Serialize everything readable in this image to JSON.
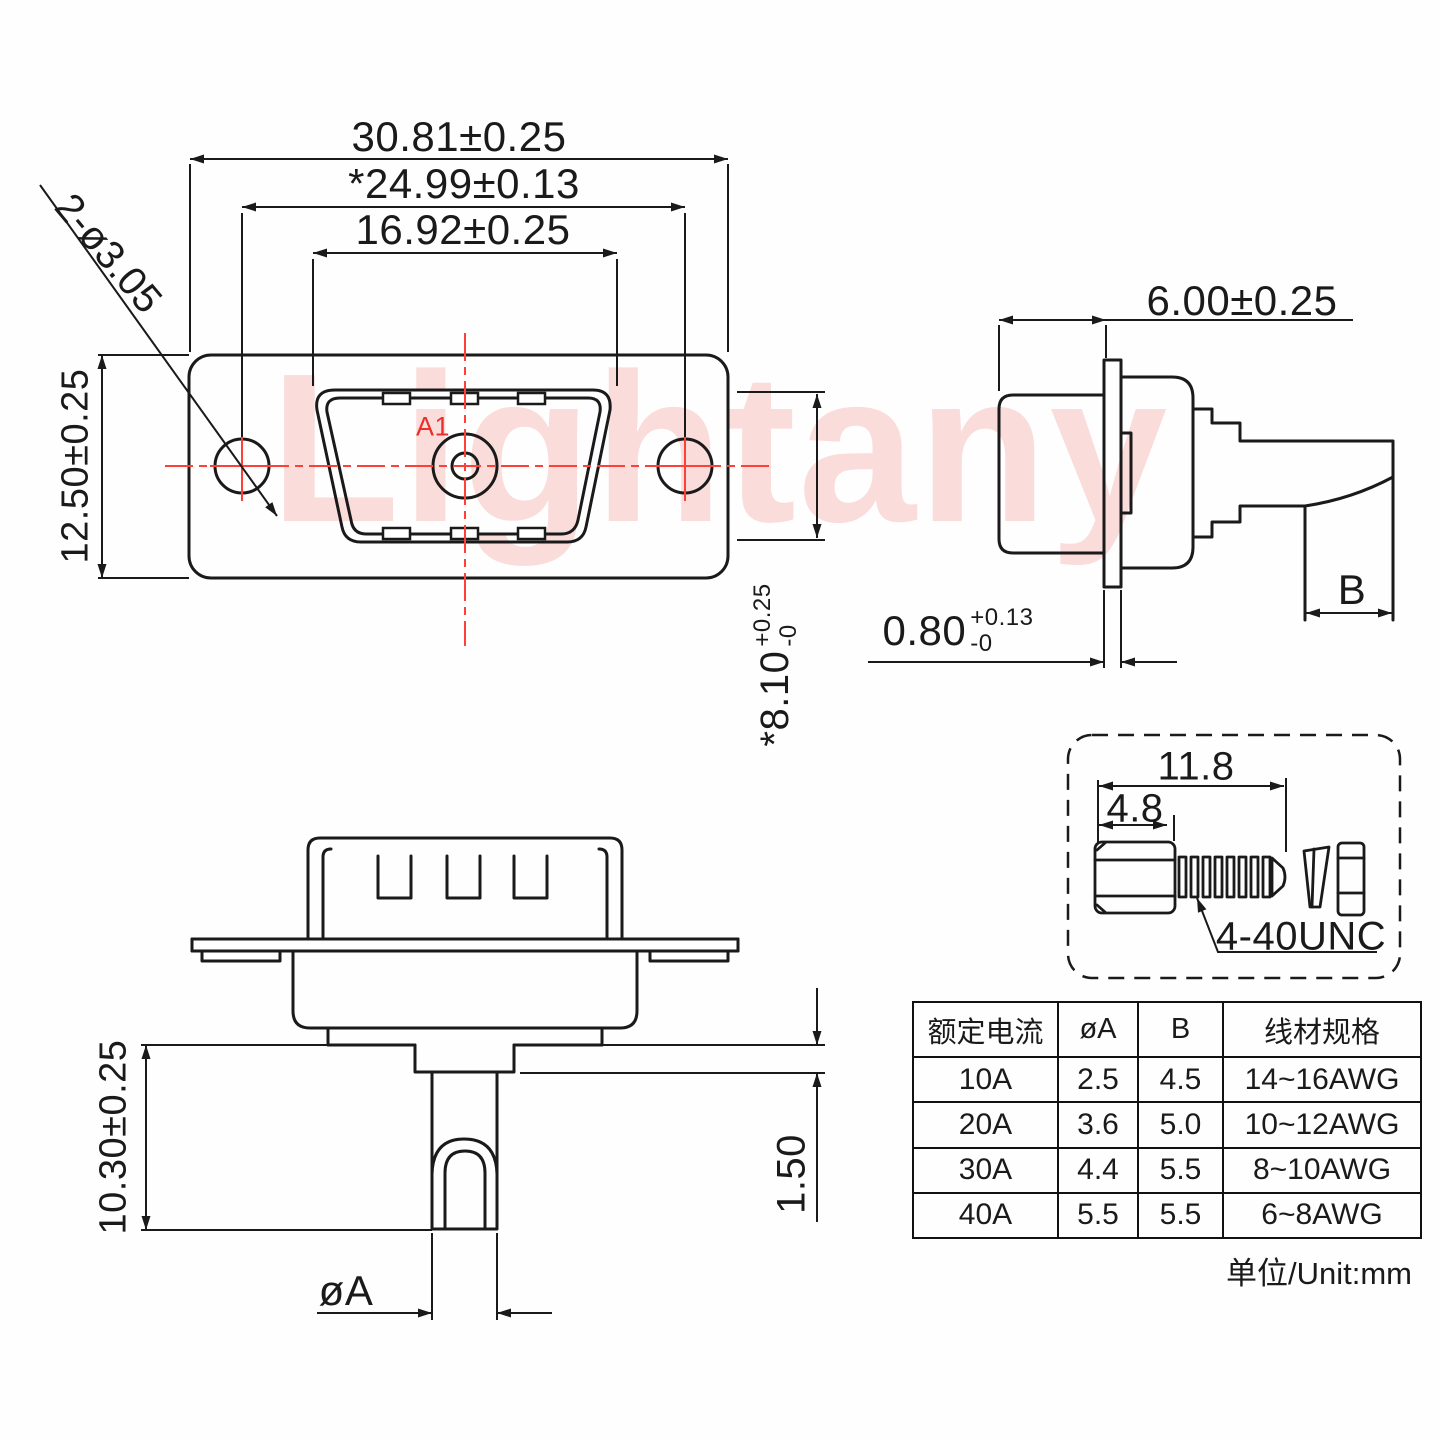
{
  "front_view": {
    "dim_flange_width": "30.81±0.25",
    "dim_hole_span": "*24.99±0.13",
    "dim_shell_width": "16.92±0.25",
    "dim_flange_height": "12.50±0.25",
    "dim_mounting_holes": "2-ø3.05",
    "dim_shell_height_main": "*8.10",
    "dim_shell_height_tol_plus": "+0.25",
    "dim_shell_height_tol_minus": "-0",
    "pin_label": "A1"
  },
  "side_view": {
    "dim_depth": "6.00±0.25",
    "dim_flange_thickness_main": "0.80",
    "dim_flange_thickness_tol_plus": "+0.13",
    "dim_flange_thickness_tol_minus": "-0",
    "dim_wire_width": "B"
  },
  "bottom_view": {
    "dim_pin_length": "10.30±0.25",
    "dim_standoff": "1.50",
    "dim_pin_diameter": "øA"
  },
  "screw_detail": {
    "dim_overall_length": "11.8",
    "dim_head_length": "4.8",
    "thread_label": "4-40UNC"
  },
  "spec_table": {
    "headers": [
      "额定电流",
      "øA",
      "B",
      "线材规格"
    ],
    "rows": [
      [
        "10A",
        "2.5",
        "4.5",
        "14~16AWG"
      ],
      [
        "20A",
        "3.6",
        "5.0",
        "10~12AWG"
      ],
      [
        "30A",
        "4.4",
        "5.5",
        "8~10AWG"
      ],
      [
        "40A",
        "5.5",
        "5.5",
        "6~8AWG"
      ]
    ]
  },
  "unit_note": "单位/Unit:mm",
  "watermark": "Lightany",
  "colors": {
    "line": "#1a1a1a",
    "accent_red": "#e8312a",
    "centerline_red": "#ff4038",
    "watermark_pink": "rgba(239,125,115,0.26)"
  }
}
